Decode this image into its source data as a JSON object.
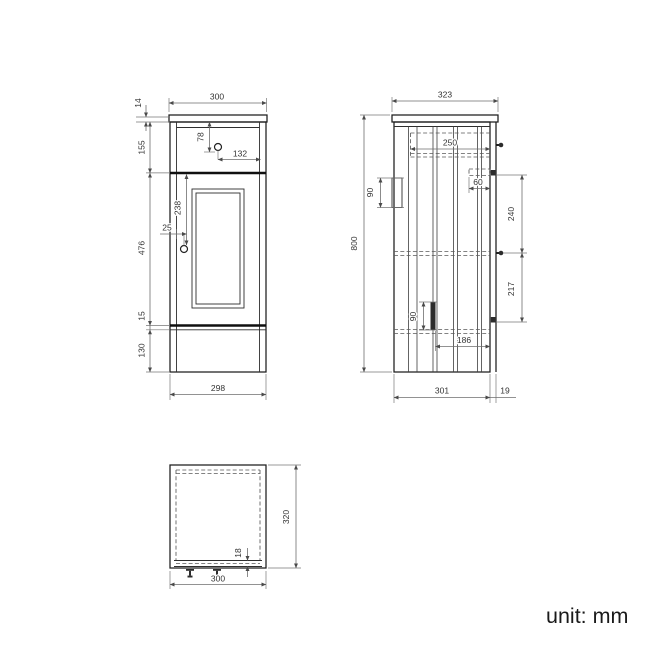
{
  "unit_label": "unit: mm",
  "views": {
    "front": {
      "label": "front elevation",
      "dims": {
        "counter_width": "300",
        "counter_thickness": "14",
        "drawer_front_height": "155",
        "drawer_knob_from_top": "78",
        "drawer_knob_from_right": "132",
        "door_knob_from_top": "238",
        "door_knob_from_edge": "25",
        "door_height": "476",
        "bottom_rail_gap": "15",
        "plinth_height": "130",
        "carcass_width": "298"
      }
    },
    "side": {
      "label": "side section",
      "dims": {
        "counter_depth": "323",
        "drawer_depth": "250",
        "wall_bracket_height": "90",
        "hinge_plate_depth": "60",
        "hinge_to_shelf": "240",
        "overall_height": "800",
        "shelf_to_lower_hinge": "217",
        "lower_bracket_height": "90",
        "lower_clearance_depth": "186",
        "carcass_depth": "301",
        "door_thickness": "19"
      }
    },
    "plan": {
      "label": "plan view",
      "dims": {
        "depth": "320",
        "front_panel_thickness": "18",
        "width": "300"
      }
    }
  }
}
